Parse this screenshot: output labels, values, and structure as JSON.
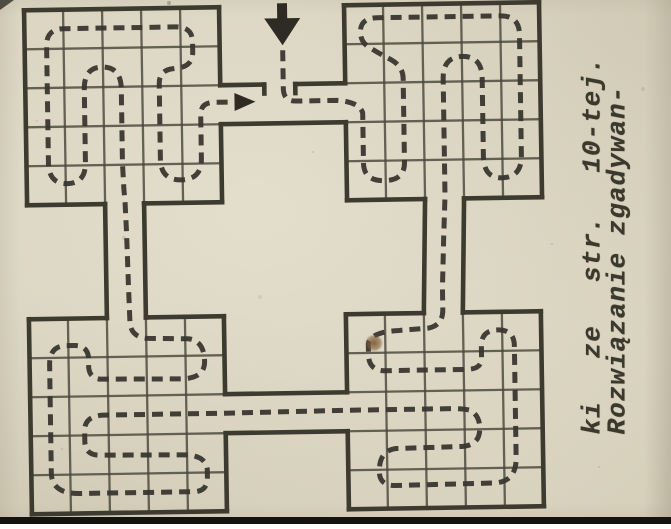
{
  "caption": {
    "line1": "Rozwiązanie zgadywan-",
    "line2_words": [
      "ki",
      "ze",
      "str.",
      "10-tej."
    ]
  },
  "colors": {
    "paper": "#d6d0bb",
    "ink": "#3d3a30",
    "grid_ink": "#4a473c",
    "path_ink": "#393630",
    "arrow_ink": "#2e2b24",
    "edge_bar": "#141310",
    "stain": "#7d5c36"
  },
  "maze": {
    "canvas": {
      "w": 671,
      "h": 524
    },
    "blocks": [
      {
        "name": "top-left",
        "x": 28,
        "y": 6,
        "w": 195,
        "h": 195,
        "cells": 5,
        "openings": [
          {
            "side": "right",
            "from": 78,
            "to": 117
          },
          {
            "side": "bottom",
            "from": 78,
            "to": 117
          }
        ]
      },
      {
        "name": "top-right",
        "x": 348,
        "y": 6,
        "w": 195,
        "h": 195,
        "cells": 5,
        "openings": [
          {
            "side": "left",
            "from": 78,
            "to": 117
          },
          {
            "side": "bottom",
            "from": 78,
            "to": 117
          }
        ]
      },
      {
        "name": "bottom-left",
        "x": 28,
        "y": 315,
        "w": 195,
        "h": 195,
        "cells": 5,
        "openings": [
          {
            "side": "top",
            "from": 78,
            "to": 117
          },
          {
            "side": "right",
            "from": 78,
            "to": 117
          }
        ]
      },
      {
        "name": "bottom-right",
        "x": 345,
        "y": 315,
        "w": 195,
        "h": 195,
        "cells": 5,
        "openings": [
          {
            "side": "top",
            "from": 78,
            "to": 117
          },
          {
            "side": "left",
            "from": 78,
            "to": 117
          }
        ]
      }
    ],
    "corridor_walls": [
      [
        223,
        84,
        267,
        84
      ],
      [
        298,
        84,
        348,
        84
      ],
      [
        223,
        123,
        348,
        123
      ],
      [
        106,
        201,
        106,
        315
      ],
      [
        145,
        201,
        145,
        315
      ],
      [
        426,
        201,
        423,
        315
      ],
      [
        465,
        201,
        462,
        315
      ],
      [
        223,
        393,
        345,
        393
      ],
      [
        223,
        432,
        345,
        432
      ]
    ],
    "gate_ticks": [
      [
        267,
        84,
        267,
        93
      ],
      [
        298,
        84,
        298,
        93
      ]
    ],
    "route_d": "M286,50 L286,88 Q286,101 298,101 L340,101 Q362,103 365,114 L365,164 Q365,182 385.5,182 Q406,182 406,164 L406,80 Q406,68 394,61 Q381,54 372,48 Q364,43 364,33 Q364,19 381,19 L504,19 Q523,19 523,38 L523,159 Q523,181 503,181 Q485,181 485,159 L485,81 Q485,59 465.5,59 Q446,59 446,81 L446,198 L444,240 L442,290 L442,312 Q442,327 428,330 L398,332 Q369,333 367,345 L367,356 Q367,371 382,372 L465,372 Q480,372 480,361 L480,349 Q480,333 496.5,333 Q513,333 513,349 L513,461 Q513,485 491,486 L392,487 Q376,487 376,473 Q376,452 393,450 L459,449 Q476,448 477,433 Q478,419 468,413 Q461,411 448,411 L345,411 L223,412 L102,412 Q83,412 82,426 L82,438 Q82,452 97,452 L182,453 Q203,454 204,468 L204,476 Q204,490 190,490 L76,490 Q48,490 48,469 L48,361 Q48,343 63,342 L73,342 Q86,342 87,354 L87,364 Q88,376 100,376 L179,377 Q203,377 203,360 Q203,339 187,337 L147,336 Q130,335 129,320 L128,280 L127,230 L126,200 L125,186 L124,160 L124,86 Q124,64 105,64 Q87,64 87,86 L87,159 Q87,180 68.5,180 Q50,180 50,159 L50,42 Q50,25 67,25 L179,25 Q196,25 196,40 L196,50 Q196,64 182,66 L174,67 Q162,69 162,82 L162,157 Q162,178 182.5,178 Q203,178 203,157 L203,113 Q203,101 217,101 L234,101",
    "entry_arrow": {
      "shaft": [
        281,
        3,
        10,
        16
      ],
      "head": "268,18 304,18 286,45"
    },
    "end_arrow": {
      "head": "237,92 237,110 258,101"
    }
  }
}
